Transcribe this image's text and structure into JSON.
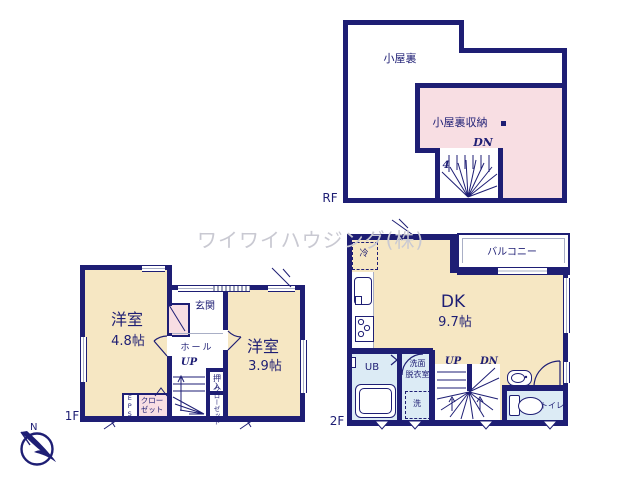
{
  "watermark": {
    "text": "ワイワイハウジング(株)"
  },
  "colors": {
    "wall_navy": "#1e1e74",
    "room_beige": "#f6e7c3",
    "storage_pink": "#f8dee3",
    "wet_area_blue": "#dcebf5",
    "window_gray": "#a9afc6",
    "watermark_gray": "#c9c9d2"
  },
  "compass": {
    "north_label": "N"
  },
  "rf": {
    "floor_label": "RF",
    "attic": "小屋裏",
    "attic_storage": "小屋裏収納",
    "stairs_dn": "DN",
    "stairs_count": "4"
  },
  "f2": {
    "floor_label": "2F",
    "dk": "DK",
    "dk_size": "9.7帖",
    "balcony": "バルコニー",
    "fridge": "冷",
    "ub": "UB",
    "washroom_line1": "洗面",
    "washroom_line2": "脱衣室",
    "washer": "洗",
    "stairs_up": "UP",
    "stairs_dn": "DN",
    "toilet": "トイレ"
  },
  "f1": {
    "floor_label": "1F",
    "room_left": "洋室",
    "room_left_size": "4.8帖",
    "room_right": "洋室",
    "room_right_size": "3.9帖",
    "entrance": "玄関",
    "hall": "ホール",
    "stairs_up": "UP",
    "oshiire": "押入",
    "closet_vertical": "クローゼット",
    "closet_line1": "クロー",
    "closet_line2": "ゼット",
    "eps": "EPS"
  }
}
